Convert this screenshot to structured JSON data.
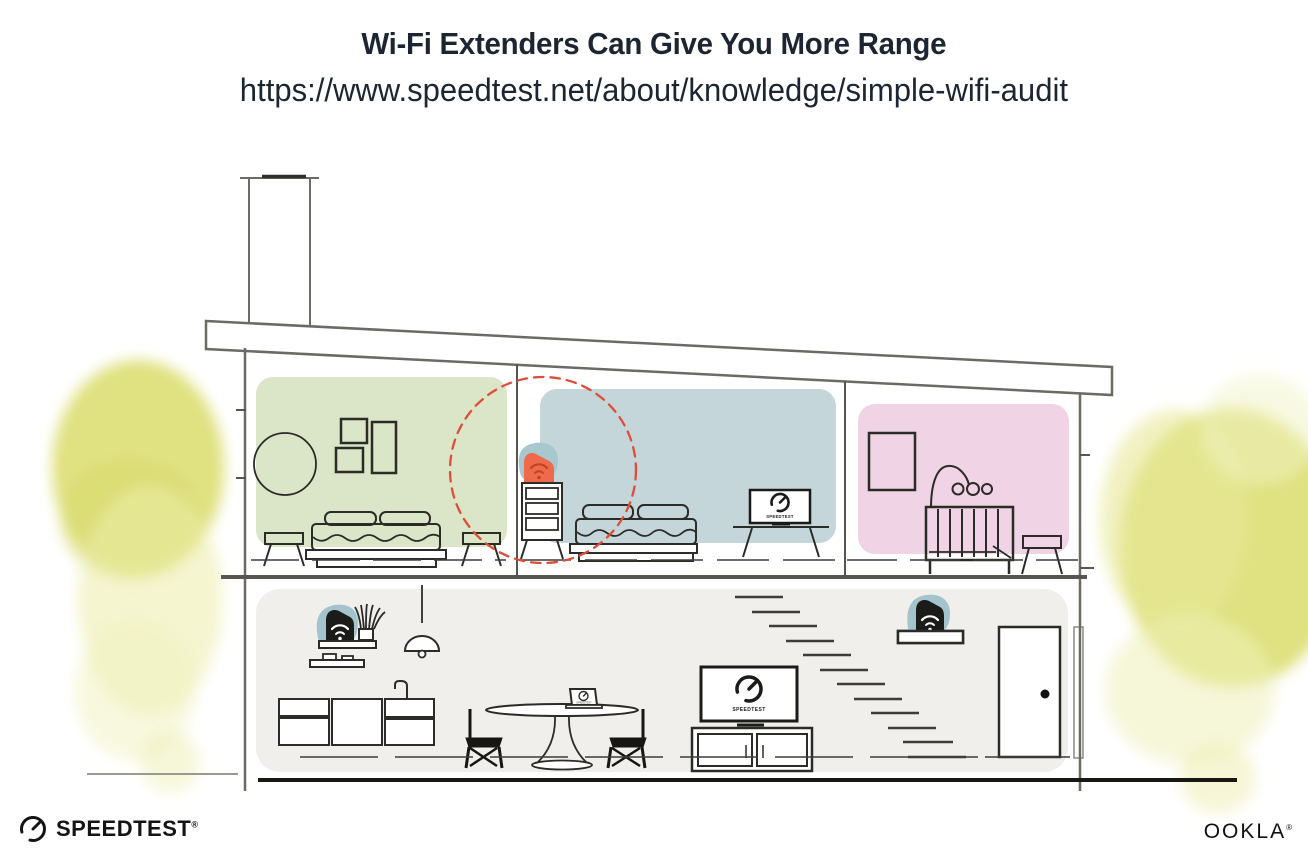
{
  "header": {
    "title": "Wi-Fi Extenders Can Give You More Range",
    "url": "https://www.speedtest.net/about/knowledge/simple-wifi-audit"
  },
  "illustration": {
    "bedroom_tv_label": "SPEEDTEST",
    "living_room_tv_label": "SPEEDTEST",
    "laptop_screen_label": "SPEEDTEST",
    "rooms": [
      {
        "name": "left bedroom",
        "wall_color": "#dbe5c7"
      },
      {
        "name": "middle bedroom",
        "wall_color": "#c4d6da"
      },
      {
        "name": "nursery",
        "wall_color": "#f0d4e5"
      },
      {
        "name": "main floor",
        "wall_color": "#f0efec"
      }
    ],
    "devices": [
      {
        "type": "wifi-extender",
        "location": "dresser in middle bedroom",
        "body_color": "#ee6a4b",
        "halo_color": "#a3c4cc"
      },
      {
        "type": "wifi-router",
        "location": "kitchen shelf",
        "body_color": "#1b1b19",
        "halo_color": "#a3c4cc"
      },
      {
        "type": "wifi-router",
        "location": "shelf above stairs",
        "body_color": "#1b1b19",
        "halo_color": "#a3c4cc"
      }
    ],
    "coverage_circle_color": "#de4e37",
    "foliage_color": "#dedf79",
    "line_color": "#2b2b27",
    "structure_color": "#6b6b63"
  },
  "footer": {
    "speedtest_wordmark": "SPEEDTEST",
    "speedtest_reg_mark": "®",
    "ookla_wordmark": "OOKLA",
    "ookla_reg_mark": "®"
  }
}
